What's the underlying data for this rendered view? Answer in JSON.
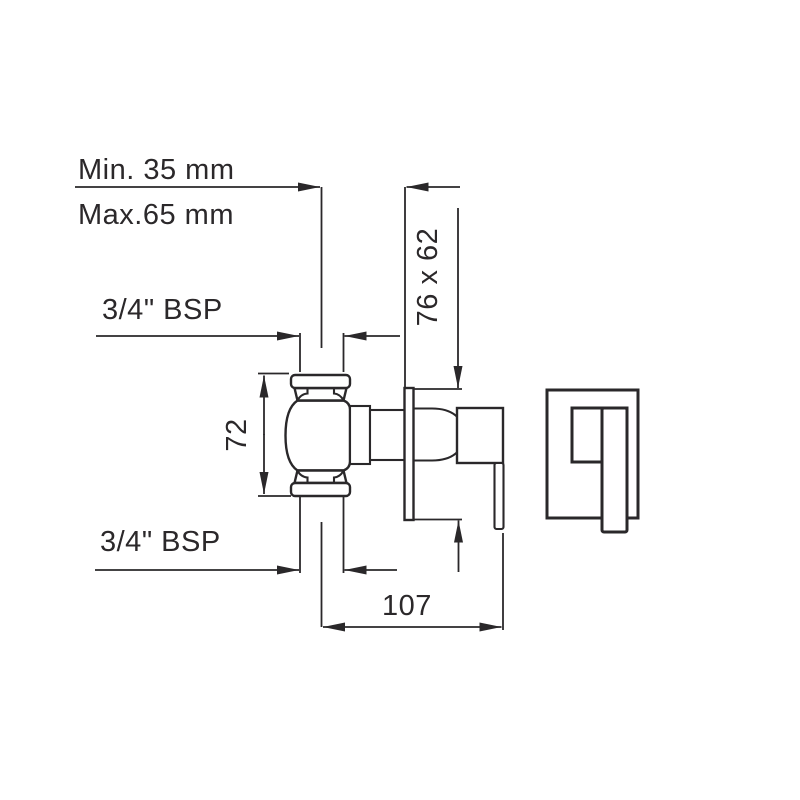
{
  "diagram_type": "technical-dimension-drawing",
  "colors": {
    "line": "#2a282a",
    "text": "#2b282a",
    "background": "#ffffff"
  },
  "labels": {
    "min_depth": "Min. 35 mm",
    "max_depth": "Max.65 mm",
    "inlet_top": "3/4\" BSP",
    "inlet_bottom": "3/4\" BSP",
    "body_height": "72",
    "plate_size": "76 x 62",
    "projection": "107"
  }
}
